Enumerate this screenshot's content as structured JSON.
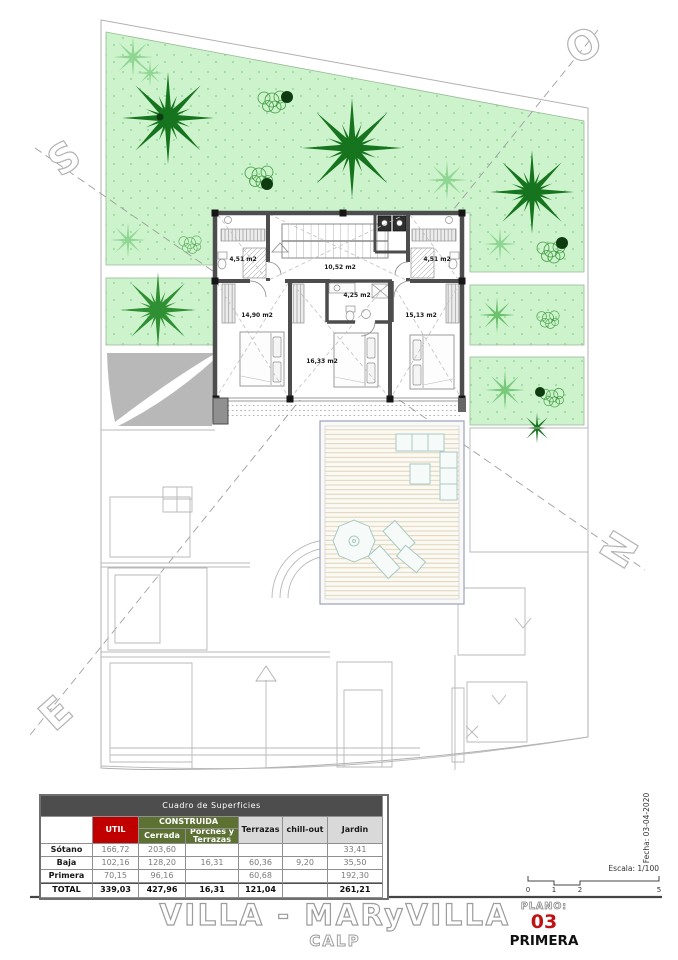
{
  "plan": {
    "compass": {
      "north": "N",
      "south": "S",
      "east": "E",
      "west": "O"
    },
    "rooms": [
      {
        "name": "bath-top-left",
        "label": "4,51 m2"
      },
      {
        "name": "hall-stairs",
        "label": "10,52 m2"
      },
      {
        "name": "bath-top-right",
        "label": "4,51 m2"
      },
      {
        "name": "bedroom-left",
        "label": "14,90 m2"
      },
      {
        "name": "bath-center",
        "label": "4,25 m2"
      },
      {
        "name": "bedroom-right",
        "label": "15,13 m2"
      },
      {
        "name": "bedroom-center",
        "label": "16,33 m2"
      }
    ],
    "scale_text": "Escala: 1/100",
    "date_text": "Fecha: 03-04-2020",
    "scale_ticks": [
      "0",
      "1",
      "2",
      "5"
    ],
    "colors": {
      "garden_green": "#cdf3cc",
      "palm_dark_green": "#15741d",
      "wall_gray": "#4d4d4d",
      "accent_red": "#c00000",
      "header_olive": "#5d7232",
      "header_gray": "#4d4d4d"
    }
  },
  "table": {
    "title": "Cuadro de Superficies",
    "headers": {
      "util": "UTIL",
      "construida": "CONSTRUIDA",
      "cerrada": "Cerrada",
      "porches": "Porches y Terrazas",
      "terrazas": "Terrazas",
      "chillout": "chill-out",
      "jardin": "Jardin"
    },
    "rows": [
      {
        "label": "Sótano",
        "util": "166,72",
        "cerrada": "203,60",
        "porches": "",
        "terrazas": "",
        "chillout": "",
        "jardin": "33,41"
      },
      {
        "label": "Baja",
        "util": "102,16",
        "cerrada": "128,20",
        "porches": "16,31",
        "terrazas": "60,36",
        "chillout": "9,20",
        "jardin": "35,50"
      },
      {
        "label": "Primera",
        "util": "70,15",
        "cerrada": "96,16",
        "porches": "",
        "terrazas": "60,68",
        "chillout": "",
        "jardin": "192,30"
      },
      {
        "label": "TOTAL",
        "util": "339,03",
        "cerrada": "427,96",
        "porches": "16,31",
        "terrazas": "121,04",
        "chillout": "",
        "jardin": "261,21"
      }
    ]
  },
  "titleblock": {
    "project": "VILLA - MARyVILLA",
    "location": "CALP",
    "plano_label": "PLANO:",
    "plano_number": "03",
    "plano_name": "PRIMERA"
  }
}
